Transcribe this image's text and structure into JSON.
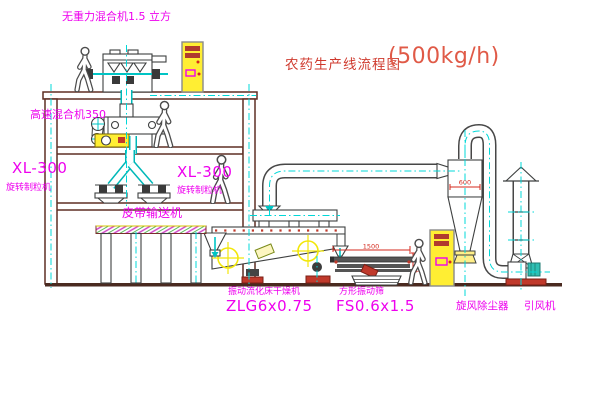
{
  "title": {
    "text": "农药生产线流程图",
    "capacity": "(500kg/h)",
    "color": "#cf3a2e"
  },
  "equipment_labels": {
    "gravity_mixer": "无重力混合机1.5 立方",
    "high_speed_mixer": "高速混合机350",
    "granulator_left": {
      "model": "XL-300",
      "name": "旋转制粒机"
    },
    "granulator_right": {
      "model": "XL-300",
      "name": "旋转制粒机"
    },
    "belt_conveyor": "皮带输送机",
    "fluid_bed_dryer": {
      "name": "振动流化床干燥机",
      "model": "ZLG6x0.75"
    },
    "vibrating_sieve": {
      "name": "方形振动筛",
      "model": "FS0.6x1.5"
    },
    "cyclone": "旋风除尘器",
    "induced_draft_fan": "引风机"
  },
  "dimensions": {
    "cyclone_width": "600",
    "sieve_length": "1500",
    "sieve_height": "541"
  },
  "colors": {
    "label_magenta": "#ee00ee",
    "title_red": "#cf3a2e",
    "centerline_cyan": "#00d8d8",
    "structure_brown": "#5e2f24",
    "equipment_gray": "#3e4040",
    "cabinet_yellow": "#ffee33",
    "accent_red": "#d42a1e",
    "background": "#ffffff"
  }
}
